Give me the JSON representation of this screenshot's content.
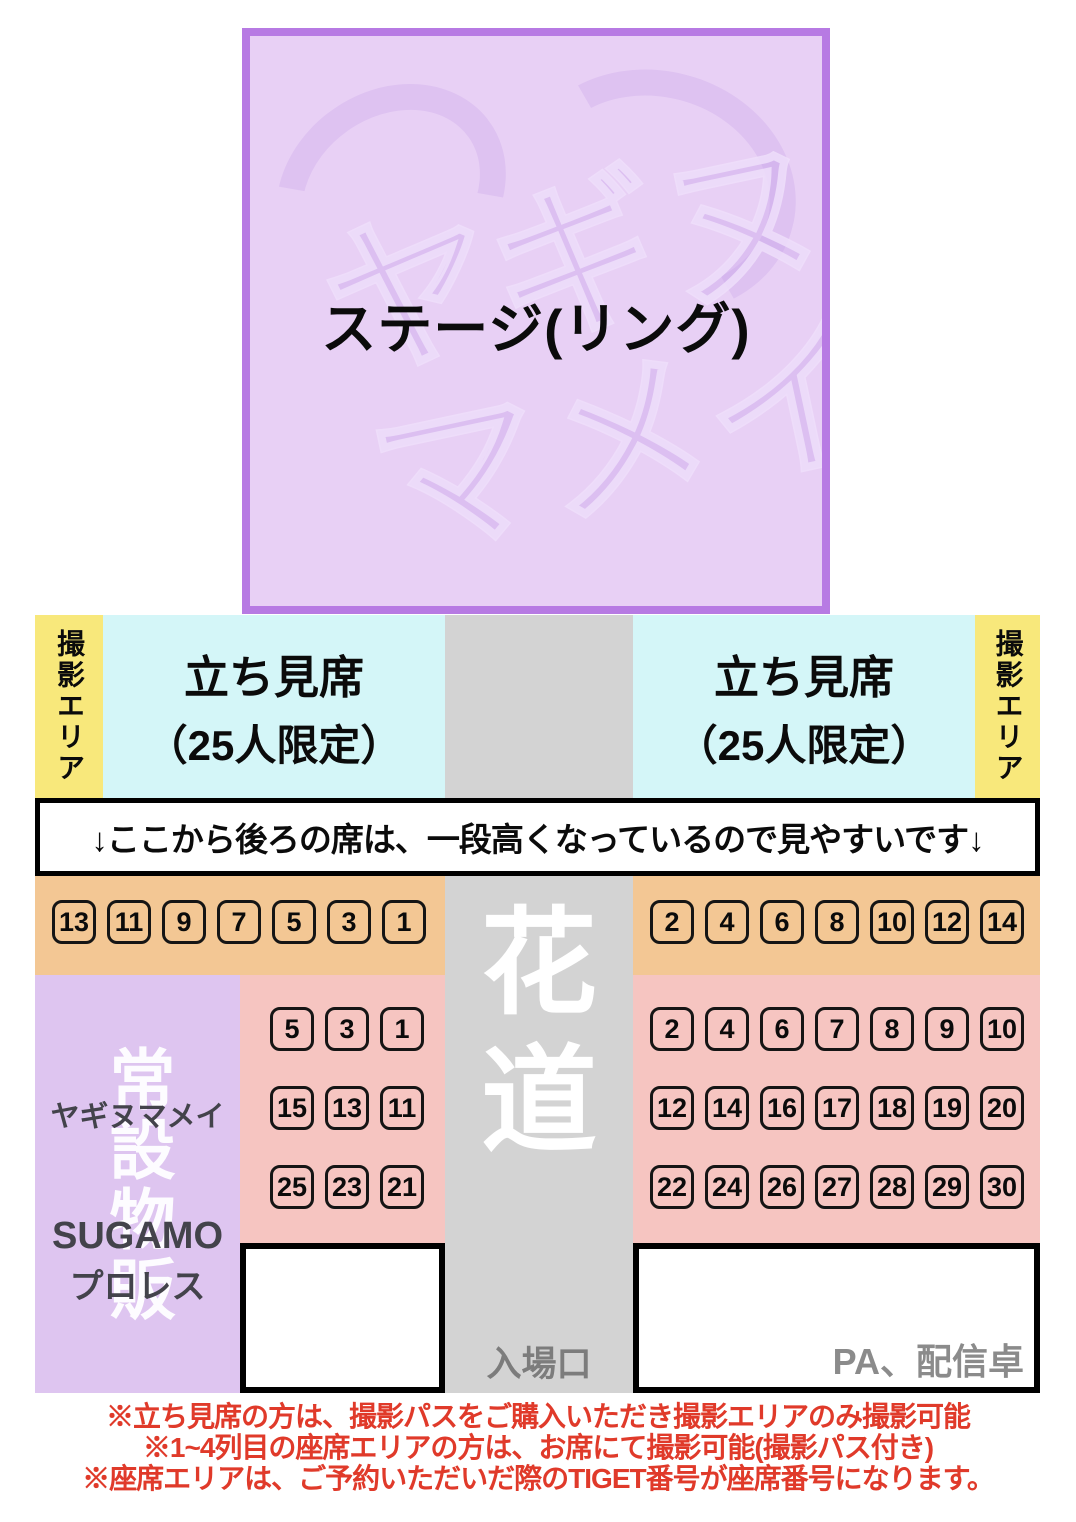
{
  "colors": {
    "stage_fill": "#e8d0f5",
    "stage_border": "#b77ae3",
    "photo_area": "#f8e87b",
    "standing": "#d4f6f8",
    "aisle": "#d3d3d3",
    "front_row": "#f3c794",
    "seat_area": "#f6c5c1",
    "merch": "#dec5f0",
    "note_red": "#e03a2a"
  },
  "stage": {
    "label": "ステージ(リング)",
    "watermark_line1": "ヤギヌ",
    "watermark_line2": "マメイ"
  },
  "photo_left": {
    "label": "撮影エリア"
  },
  "photo_right": {
    "label": "撮影エリア"
  },
  "standing_left": {
    "title": "立ち見席",
    "subtitle": "（25人限定）"
  },
  "standing_right": {
    "title": "立ち見席",
    "subtitle": "（25人限定）"
  },
  "banner": {
    "text": "↓ここから後ろの席は、一段高くなっているので見やすいです↓"
  },
  "aisle": {
    "char1": "花",
    "char2": "道",
    "entrance": "入場口"
  },
  "seating": {
    "left_front": [
      "13",
      "11",
      "9",
      "7",
      "5",
      "3",
      "1"
    ],
    "right_front": [
      "2",
      "4",
      "6",
      "8",
      "10",
      "12",
      "14"
    ],
    "left_rows": [
      [
        "5",
        "3",
        "1"
      ],
      [
        "15",
        "13",
        "11"
      ],
      [
        "25",
        "23",
        "21"
      ]
    ],
    "right_rows": [
      [
        "2",
        "4",
        "6",
        "7",
        "8",
        "9",
        "10"
      ],
      [
        "12",
        "14",
        "16",
        "17",
        "18",
        "19",
        "20"
      ],
      [
        "22",
        "24",
        "26",
        "27",
        "28",
        "29",
        "30"
      ]
    ]
  },
  "merch": {
    "watermark": "常設物販",
    "name": "ヤギヌマメイ",
    "brand_line1": "SUGAMO",
    "brand_line2": "プロレス"
  },
  "pa": {
    "label": "PA、配信卓"
  },
  "notes": [
    "※立ち見席の方は、撮影パスをご購入いただき撮影エリアのみ撮影可能",
    "※1~4列目の座席エリアの方は、お席にて撮影可能(撮影パス付き)",
    "※座席エリアは、ご予約いただいだ際のTIGET番号が座席番号になります。"
  ]
}
